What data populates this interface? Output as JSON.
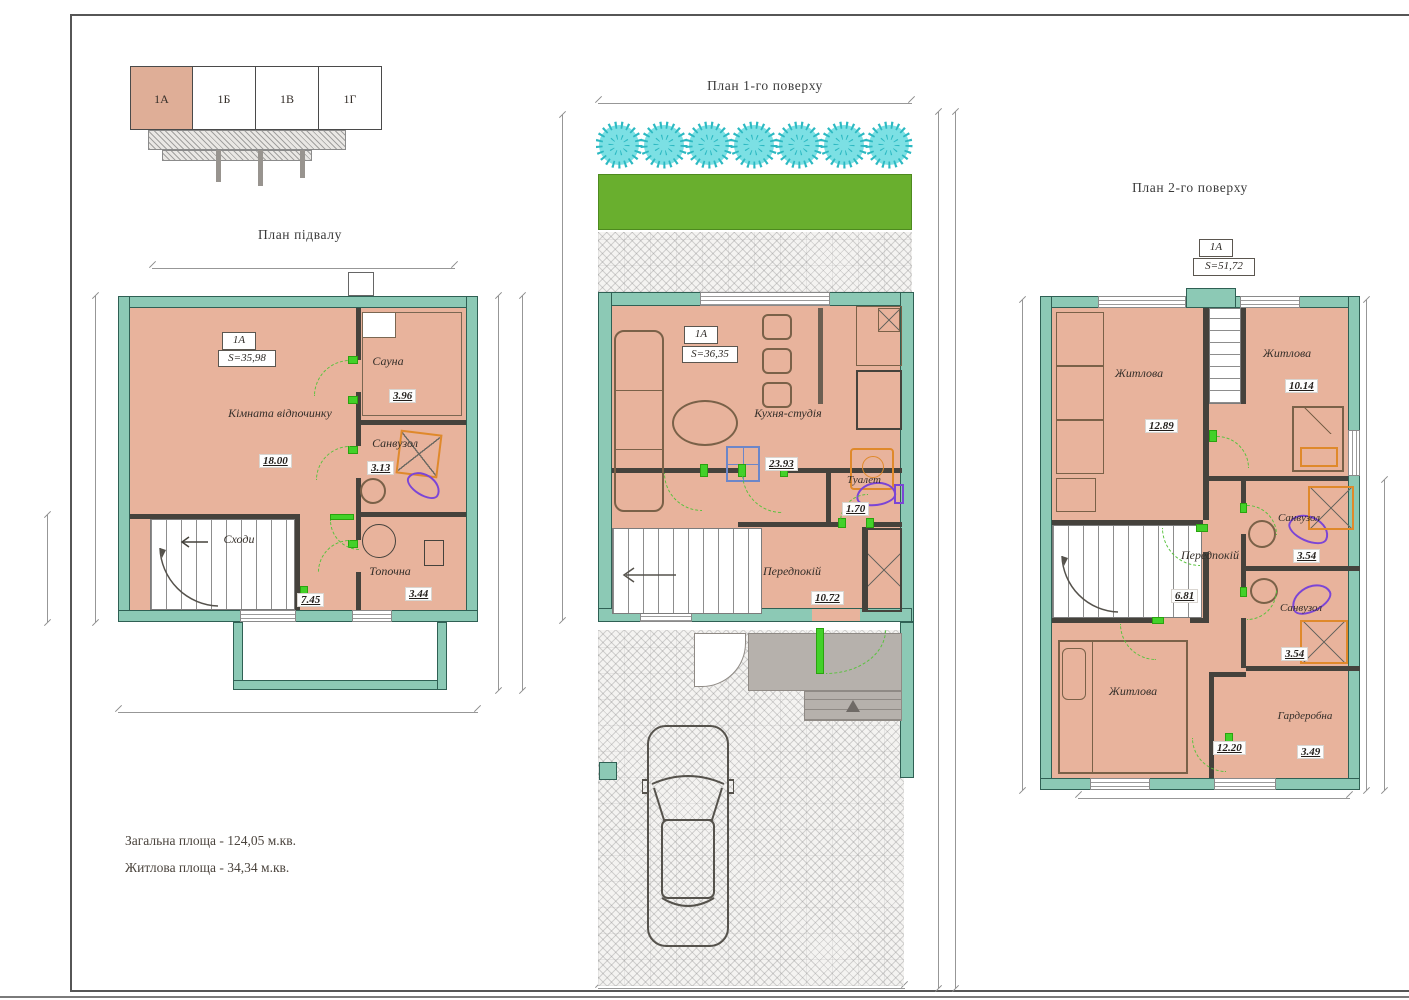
{
  "keyplan": {
    "cells": [
      {
        "label": "1А",
        "active": true
      },
      {
        "label": "1Б",
        "active": false
      },
      {
        "label": "1В",
        "active": false
      },
      {
        "label": "1Г",
        "active": false
      }
    ]
  },
  "plans": {
    "basement": {
      "title": "План підвалу",
      "unit": "1А",
      "unit_area": "S=35,98",
      "rooms": {
        "rest": {
          "name": "Кімната відпочинку",
          "area": "18.00"
        },
        "sauna": {
          "name": "Сауна",
          "area": "3.96"
        },
        "bath": {
          "name": "Санвузол",
          "area": "3.13"
        },
        "stairs": {
          "name": "Сходи"
        },
        "boiler": {
          "name": "Топочна",
          "area": "3.44"
        },
        "hall": {
          "area": "7.45"
        }
      }
    },
    "floor1": {
      "title": "План 1-го поверху",
      "unit": "1А",
      "unit_area": "S=36,35",
      "rooms": {
        "kitchen": {
          "name": "Кухня-студія",
          "area": "23.93"
        },
        "toilet": {
          "name": "Туалет",
          "area": "1.70"
        },
        "hall": {
          "name": "Передпокій",
          "area": "10.72"
        }
      }
    },
    "floor2": {
      "title": "План 2-го поверху",
      "unit": "1А",
      "unit_area": "S=51,72",
      "rooms": {
        "living1": {
          "name": "Житлова",
          "area": "12.89"
        },
        "living2": {
          "name": "Житлова",
          "area": "10.14"
        },
        "hall": {
          "name": "Передпокій",
          "area": "6.81"
        },
        "bath1": {
          "name": "Санвузол",
          "area": "3.54"
        },
        "bath2": {
          "name": "Санвузол",
          "area": "3.54"
        },
        "living3": {
          "name": "Житлова",
          "area": "12.20"
        },
        "wardrobe": {
          "name": "Гардеробна",
          "area": "3.49"
        }
      }
    }
  },
  "summary": {
    "total": "Загальна площа - 124,05 м.кв.",
    "living": "Житлова площа - 34,34 м.кв."
  },
  "colors": {
    "wall_teal": "#8cc9b5",
    "floor_salmon": "#e8b39c",
    "lawn_green": "#69af2e",
    "tree_cyan": "#6fdce1",
    "door_green": "#43d129",
    "unit_active": "#dfae97"
  }
}
